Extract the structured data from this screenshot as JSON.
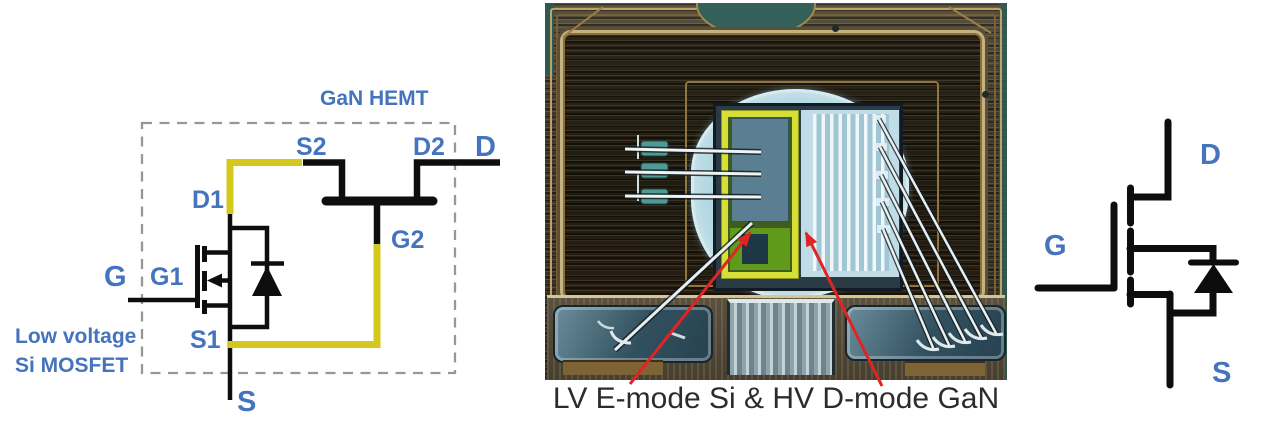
{
  "figure": {
    "left_schematic": {
      "box_label": "GaN HEMT",
      "mosfet_label_line1": "Low voltage",
      "mosfet_label_line2": "Si MOSFET",
      "terminals": {
        "gate": "G",
        "source": "S",
        "drain": "D"
      },
      "nodes": {
        "g1": "G1",
        "d1": "D1",
        "s1": "S1",
        "g2": "G2",
        "s2": "S2",
        "d2": "D2"
      }
    },
    "photo": {
      "caption": "LV E-mode Si & HV D-mode GaN"
    },
    "right_schematic": {
      "terminals": {
        "drain": "D",
        "gate": "G",
        "source": "S"
      }
    },
    "colors": {
      "label_blue": "#4573bd",
      "wire_yellow": "#d4c81d",
      "wire_black": "#0e0e0e",
      "dashed_gray": "#979797",
      "arrow_red": "#e02424",
      "caption_color": "#2c2c2c"
    }
  }
}
